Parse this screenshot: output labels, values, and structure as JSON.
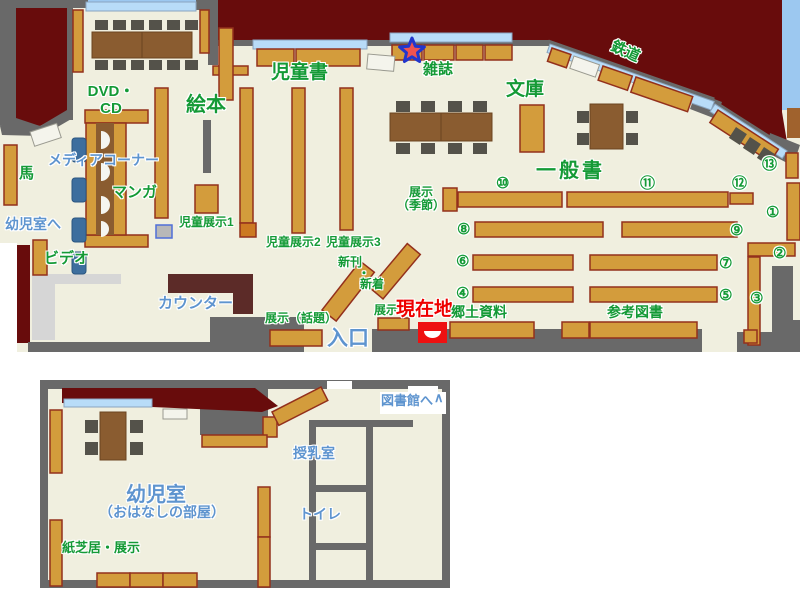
{
  "colors": {
    "wall_gray": "#696969",
    "closed_area_dark_red": "#680c0c",
    "floor_beige": "#f0efdf",
    "shelf_wood": "#d39c3c",
    "shelf_border": "#93301c",
    "table_brown": "#8a5c30",
    "chair_dark": "#54524a",
    "window_blue": "#b8dcf8",
    "sky_blue": "#9cc8f0",
    "counter_dark": "#5c2b28",
    "counter_light": "#d6d6d6",
    "label_green": "#149a36",
    "label_blue": "#5e94cf",
    "marker_red": "#ee0000",
    "media_chair_blue": "#3d6e9e"
  },
  "upper_map": {
    "section_labels": {
      "dvd_cd_line1": "DVD・",
      "dvd_cd_line2": "CD",
      "ehon": "絵本",
      "jidosho": "児童書",
      "zasshi": "雑誌",
      "bunko": "文庫",
      "tetsudo": "鉄道",
      "ippansho": "一般書",
      "media_corner": "メディアコーナー",
      "manga": "マンガ",
      "uma": "馬",
      "to_yojishitsu": "幼児室へ",
      "video": "ビデオ",
      "counter": "カウンター",
      "jido_tenji1": "児童展示1",
      "jido_tenji2": "児童展示2",
      "jido_tenji3": "児童展示3",
      "shinkan": "新刊",
      "naka_dot": "・",
      "shinchaku": "新着",
      "tenji_wadai": "展示（話題）",
      "tenji_kisetsu_line1": "展示",
      "tenji_kisetsu_line2": "（季節）",
      "tenji": "展示",
      "genzaichi": "現在地",
      "iriguchi": "入口",
      "kyodo_shiryo": "郷土資料",
      "sanko_tosho": "参考図書"
    },
    "shelf_numbers": [
      "①",
      "②",
      "③",
      "④",
      "⑤",
      "⑥",
      "⑦",
      "⑧",
      "⑨",
      "⑩",
      "⑪",
      "⑫",
      "⑬"
    ]
  },
  "lower_map": {
    "labels": {
      "yojishitsu": "幼児室",
      "yojishitsu_sub": "（おはなしの部屋）",
      "kamishibai": "紙芝居・展示",
      "junyushitsu": "授乳室",
      "toire": "トイレ",
      "to_toshokan": "図書館へ",
      "arrow": "∧"
    }
  }
}
